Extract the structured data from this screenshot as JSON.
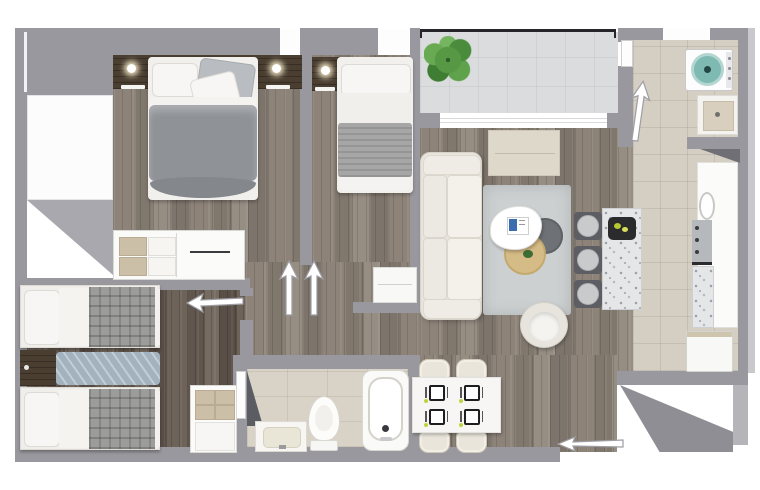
{
  "page": {
    "title": "Apartment floor plan — 3D top view render"
  },
  "colors": {
    "background": "#ffffff",
    "wall": "#98989e",
    "wall_light": "#a8a8ae",
    "wall_dark": "#6f6f75",
    "wood": "#8a8076",
    "wood_dark": "#675d53",
    "tile": "#d5cec2",
    "tile_bath": "#d9d3c7",
    "concrete": "#dadcde",
    "railing": "#26262a",
    "cream": "#e9e6df",
    "rug": "#ccd0d1",
    "duvet": "#8f9297",
    "plaid": "#9c9c9a",
    "runner": "#a3b2bf",
    "dark_wood": "#4a3e31",
    "tan_table": "#d5bb85",
    "dark_table": "#6e7176",
    "washer_teal": "#7fbab2",
    "plant": "#4c8f3f",
    "lime": "#c2d13f",
    "terrazzo": "#e4e6e8",
    "beige": "#cbbfa8"
  },
  "rooms": {
    "master_bedroom": {
      "label": "Master bedroom"
    },
    "bedroom_2": {
      "label": "Bedroom 2"
    },
    "bedroom_3": {
      "label": "Bedroom 3 (twin)"
    },
    "living_room": {
      "label": "Living room"
    },
    "dining_area": {
      "label": "Dining area"
    },
    "kitchen": {
      "label": "Kitchen"
    },
    "bathroom": {
      "label": "Bathroom"
    },
    "laundry": {
      "label": "Laundry"
    },
    "balcony": {
      "label": "Balcony"
    },
    "hallway": {
      "label": "Hallway"
    }
  },
  "furniture": {
    "double_bed": "Double bed",
    "single_bed": "Single bed",
    "twin_bed": "Twin bed",
    "nightstand": "Nightstand with lamp",
    "dresser": "Dresser / sideboard",
    "closet": "Closet",
    "shelf_unit": "Shelf unit",
    "desk": "Desk cabinet",
    "bed_runner": "Bed runner",
    "sofa": "Sofa",
    "rug": "Area rug",
    "coffee_table_white": "Coffee table (white)",
    "coffee_table_dark": "Coffee table (dark)",
    "coffee_table_tan": "Coffee table (wood)",
    "armchair": "Armchair",
    "tv_cabinet": "TV cabinet",
    "breakfast_island": "Breakfast island",
    "bar_stool": "Bar stool",
    "kitchen_counter": "Kitchen counter",
    "kitchen_sink": "Kitchen sink",
    "cooktop": "Cooktop",
    "fridge": "Refrigerator",
    "washing_machine": "Washing machine",
    "laundry_sink": "Laundry sink",
    "dining_table": "Dining table",
    "dining_chair": "Dining chair",
    "place_setting": "Place setting",
    "vanity_sink": "Vanity sink",
    "toilet": "Toilet",
    "bathtub": "Bathtub",
    "plant": "Potted plant",
    "balcony_railing": "Balcony railing",
    "sliding_door": "Sliding door",
    "window": "Window"
  },
  "doors": {
    "entry": "Main entry direction",
    "master": "Master bedroom door",
    "bedroom_2": "Bedroom 2 door",
    "bedroom_3": "Bedroom 3 door",
    "laundry": "Laundry door",
    "bathroom": "Bathroom door"
  }
}
